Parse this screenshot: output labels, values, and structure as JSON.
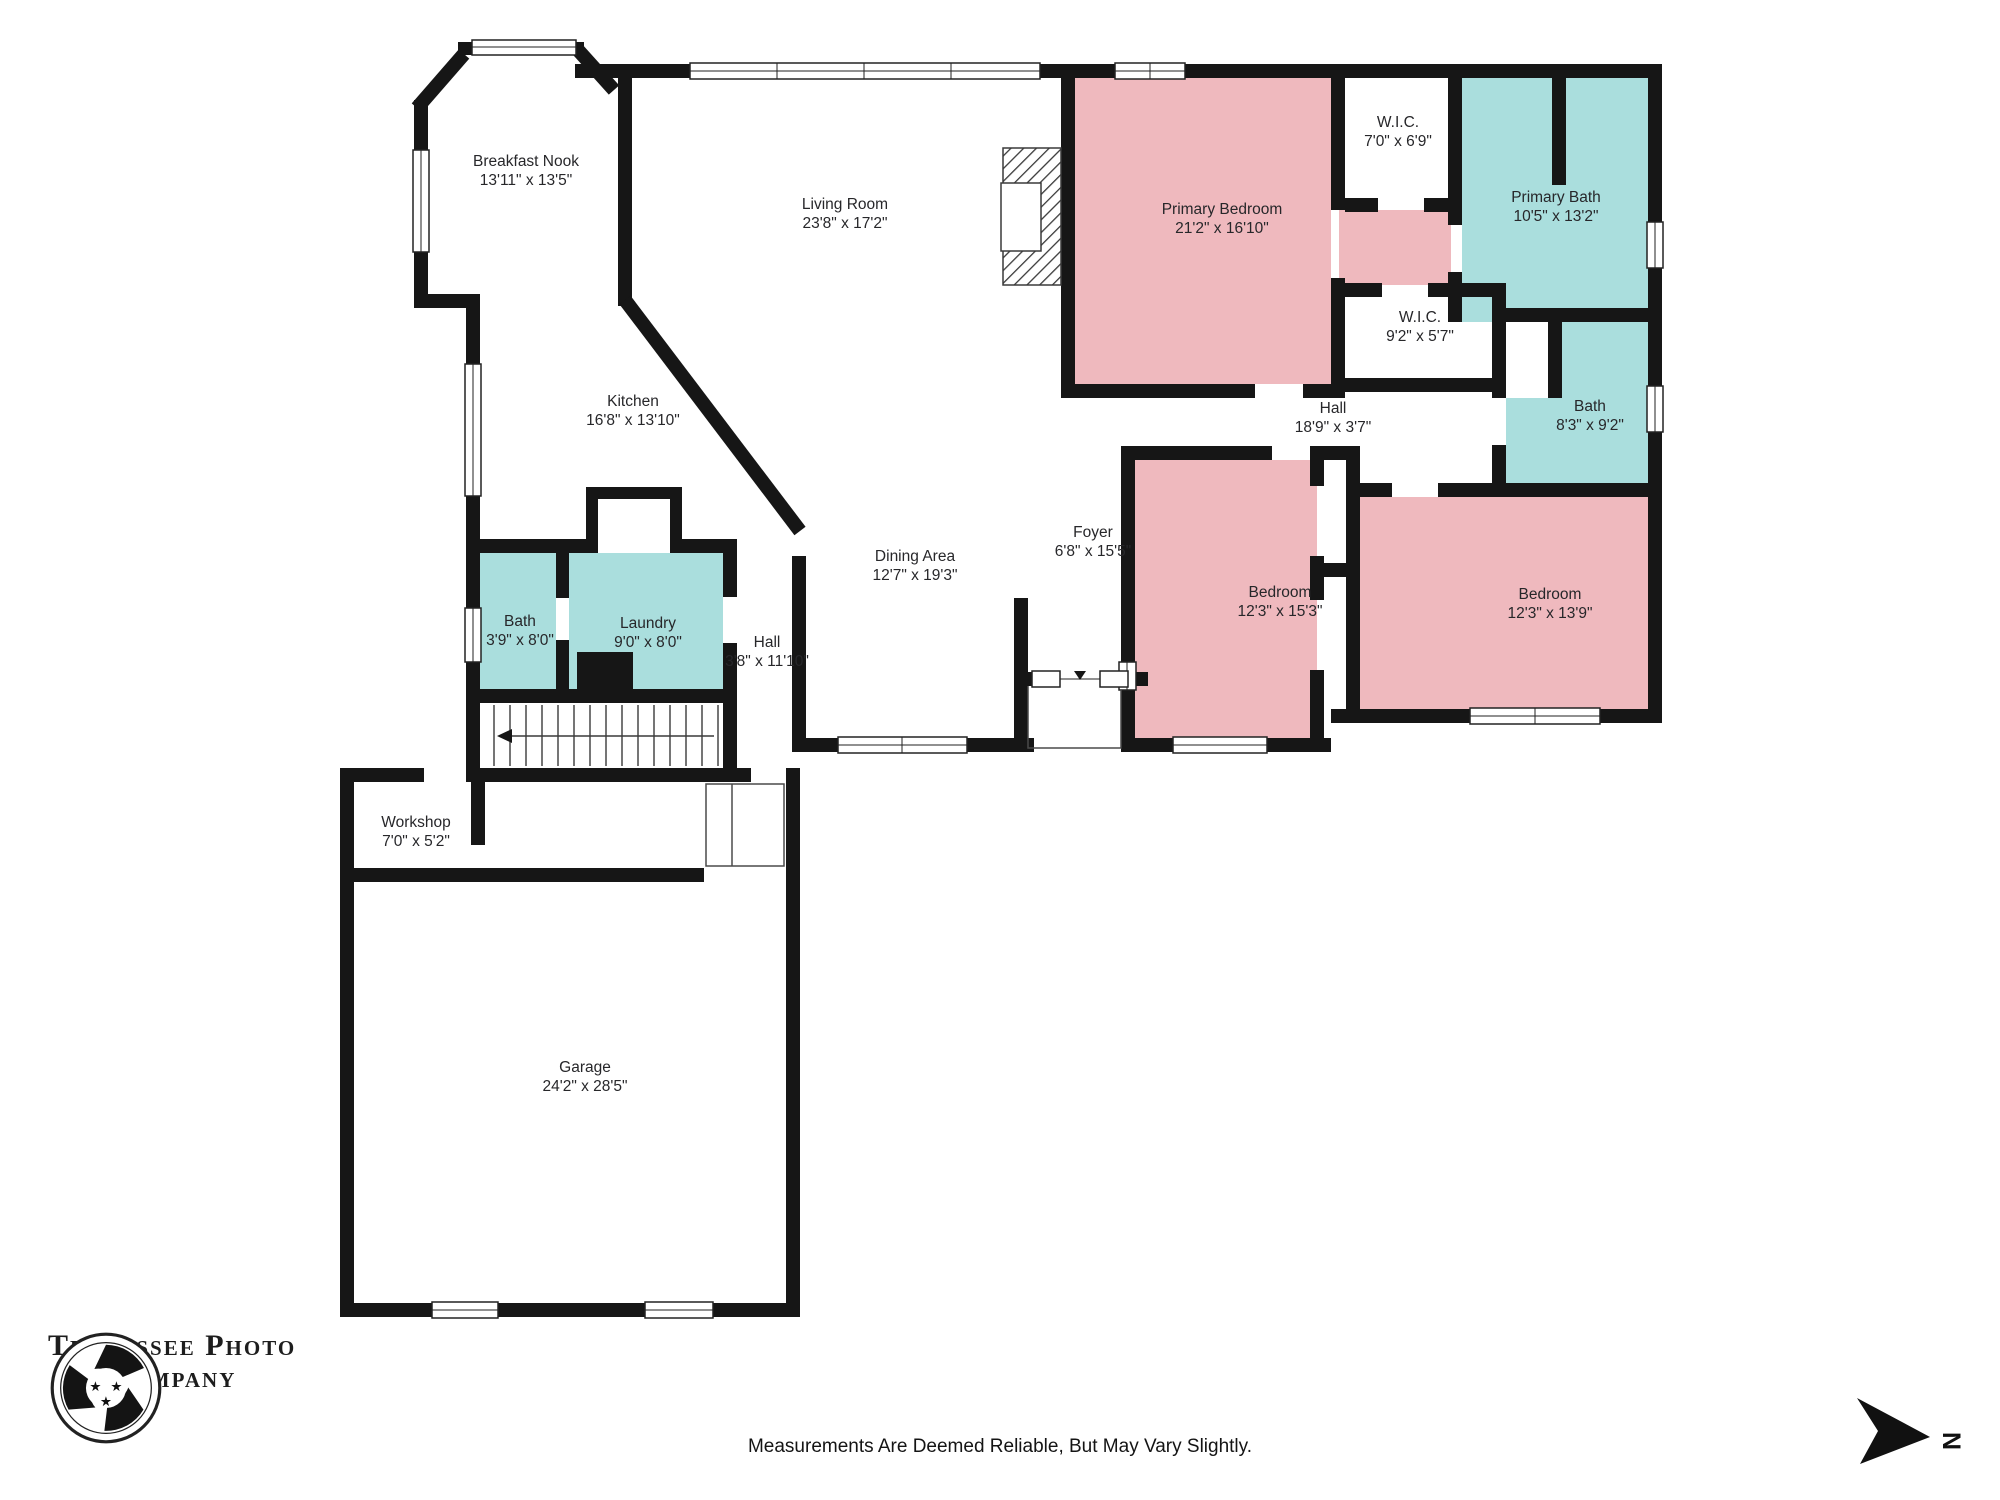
{
  "title": "Floor Plan",
  "colors": {
    "bedroom_pink": "#efb9be",
    "bath_teal": "#aadedd",
    "wall_black": "#161616",
    "background": "#ffffff"
  },
  "rooms": [
    {
      "id": "breakfast-nook",
      "name": "Breakfast Nook",
      "dims": "13'11\" x 13'5\""
    },
    {
      "id": "living-room",
      "name": "Living Room",
      "dims": "23'8\" x 17'2\""
    },
    {
      "id": "kitchen",
      "name": "Kitchen",
      "dims": "16'8\" x 13'10\""
    },
    {
      "id": "primary-bedroom",
      "name": "Primary Bedroom",
      "dims": "21'2\" x 16'10\""
    },
    {
      "id": "wic-1",
      "name": "W.I.C.",
      "dims": "7'0\" x 6'9\""
    },
    {
      "id": "primary-bath",
      "name": "Primary Bath",
      "dims": "10'5\" x 13'2\""
    },
    {
      "id": "wic-2",
      "name": "W.I.C.",
      "dims": "9'2\" x 5'7\""
    },
    {
      "id": "hall-upper",
      "name": "Hall",
      "dims": "18'9\" x 3'7\""
    },
    {
      "id": "bath-2",
      "name": "Bath",
      "dims": "8'3\" x 9'2\""
    },
    {
      "id": "dining-area",
      "name": "Dining Area",
      "dims": "12'7\" x 19'3\""
    },
    {
      "id": "foyer",
      "name": "Foyer",
      "dims": "6'8\" x 15'5\""
    },
    {
      "id": "bedroom-1",
      "name": "Bedroom",
      "dims": "12'3\" x 15'3\""
    },
    {
      "id": "bedroom-2",
      "name": "Bedroom",
      "dims": "12'3\" x 13'9\""
    },
    {
      "id": "bath-1",
      "name": "Bath",
      "dims": "3'9\" x 8'0\""
    },
    {
      "id": "laundry",
      "name": "Laundry",
      "dims": "9'0\" x 8'0\""
    },
    {
      "id": "hall-lower",
      "name": "Hall",
      "dims": "3'8\" x 11'10\""
    },
    {
      "id": "workshop",
      "name": "Workshop",
      "dims": "7'0\" x 5'2\""
    },
    {
      "id": "garage",
      "name": "Garage",
      "dims": "24'2\" x 28'5\""
    }
  ],
  "footer": {
    "disclaimer": "Measurements Are Deemed Reliable, But May Vary Slightly."
  },
  "logo": {
    "line1": "Tennessee Photo",
    "line2": "Company"
  },
  "compass": {
    "label": "N"
  }
}
